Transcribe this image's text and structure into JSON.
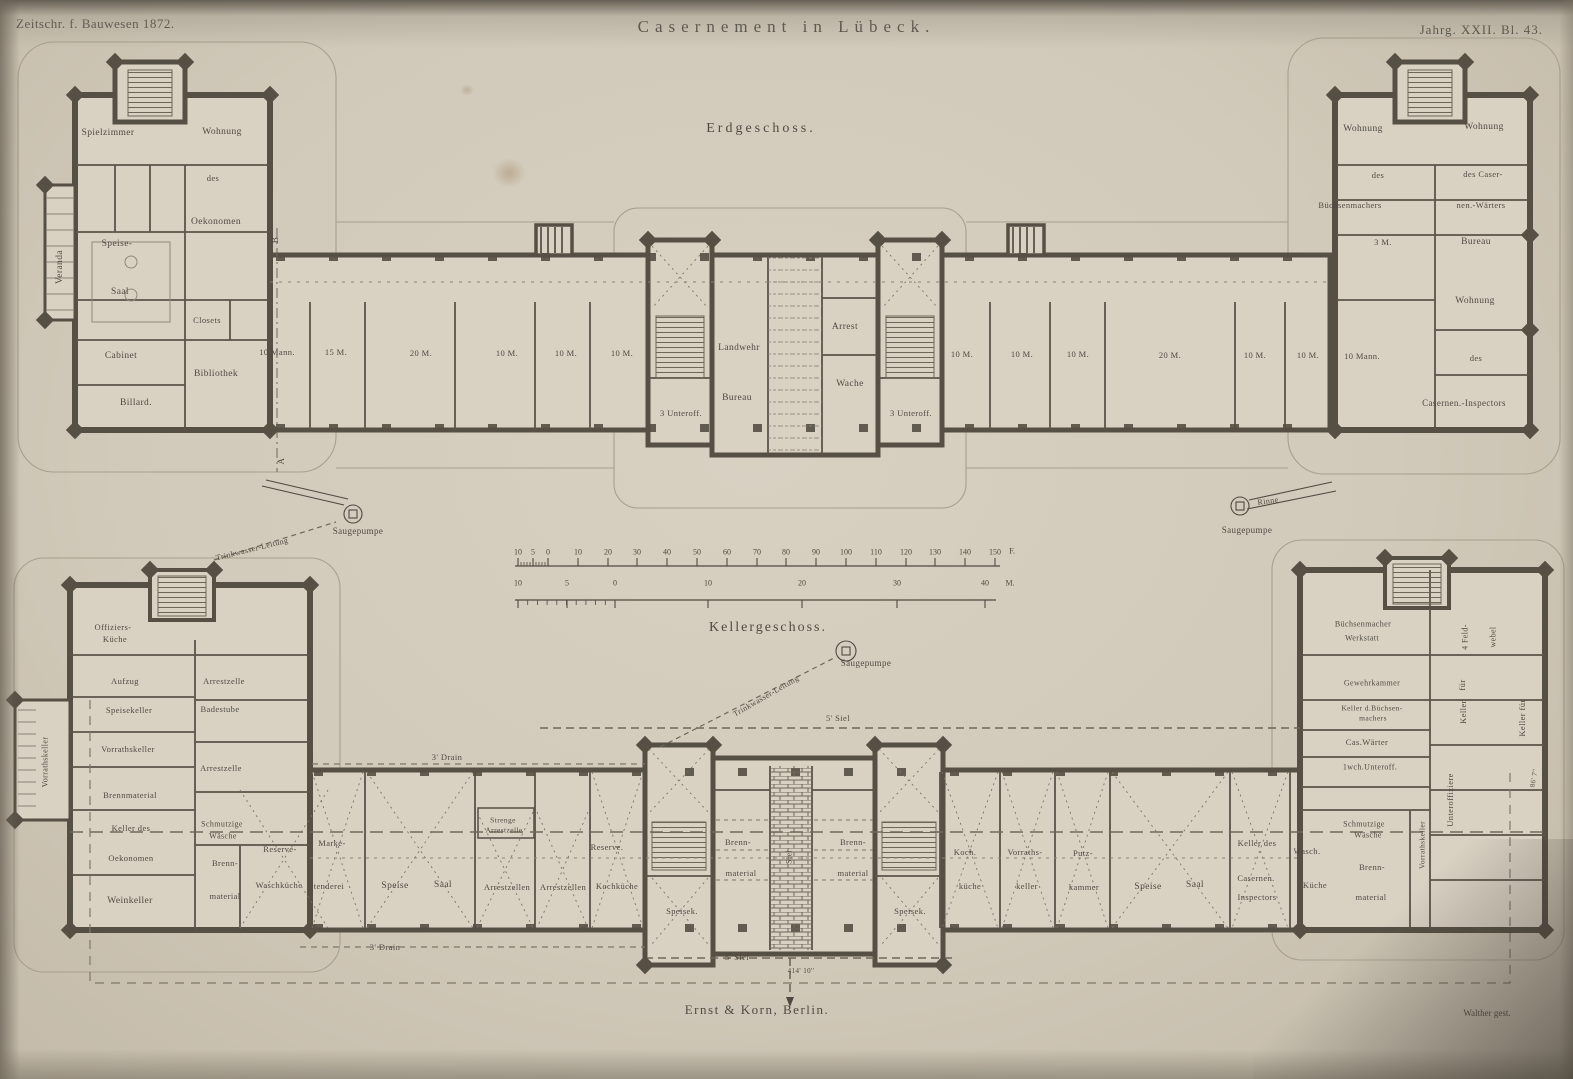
{
  "page": {
    "header": {
      "journal": "Zeitschr. f. Bauwesen 1872.",
      "title": "Casernement in Lübeck.",
      "plate_ref": "Jahrg. XXII. Bl. 43."
    },
    "footer": {
      "publisher": "Ernst & Korn, Berlin.",
      "engraver": "Walther gest."
    }
  },
  "colors": {
    "paper": "#d6cfc0",
    "ink": "#4f4a41",
    "wall": "#564f44",
    "line_light": "#a59d8c",
    "dash": "#6f6859",
    "shadow": "#5b5547"
  },
  "floors": [
    {
      "name": "Erdgeschoss",
      "labels": [
        {
          "t": "Erdgeschoss.",
          "x": 761,
          "y": 129,
          "s": 14,
          "ls": 3
        },
        {
          "t": "Spielzimmer",
          "x": 108,
          "y": 133
        },
        {
          "t": "Wohnung",
          "x": 222,
          "y": 132
        },
        {
          "t": "des",
          "x": 213,
          "y": 178,
          "s": 8.5
        },
        {
          "t": "Oekonomen",
          "x": 216,
          "y": 222
        },
        {
          "t": "Speise-",
          "x": 117,
          "y": 244
        },
        {
          "t": "Saal",
          "x": 120,
          "y": 292
        },
        {
          "t": "Veranda",
          "x": 60,
          "y": 267,
          "r": -90
        },
        {
          "t": "Closets",
          "x": 207,
          "y": 320,
          "s": 8.5
        },
        {
          "t": "Cabinet",
          "x": 121,
          "y": 356
        },
        {
          "t": "Bibliothek",
          "x": 216,
          "y": 374
        },
        {
          "t": "Billard.",
          "x": 136,
          "y": 403
        },
        {
          "t": "10 Mann.",
          "x": 277,
          "y": 352,
          "s": 8.5
        },
        {
          "t": "15 M.",
          "x": 336,
          "y": 352,
          "s": 8.5
        },
        {
          "t": "20 M.",
          "x": 421,
          "y": 353,
          "s": 8.5
        },
        {
          "t": "10 M.",
          "x": 507,
          "y": 353,
          "s": 8.5
        },
        {
          "t": "10 M.",
          "x": 566,
          "y": 353,
          "s": 8.5
        },
        {
          "t": "10 M.",
          "x": 622,
          "y": 353,
          "s": 8.5
        },
        {
          "t": "Landwehr",
          "x": 739,
          "y": 348
        },
        {
          "t": "Bureau",
          "x": 737,
          "y": 398
        },
        {
          "t": "Arrest",
          "x": 845,
          "y": 327
        },
        {
          "t": "Wache",
          "x": 850,
          "y": 384
        },
        {
          "t": "3 Unteroff.",
          "x": 681,
          "y": 413,
          "s": 8.5
        },
        {
          "t": "3 Unteroff.",
          "x": 911,
          "y": 413,
          "s": 8.5
        },
        {
          "t": "10 M.",
          "x": 962,
          "y": 354,
          "s": 8.5
        },
        {
          "t": "10 M.",
          "x": 1022,
          "y": 354,
          "s": 8.5
        },
        {
          "t": "10 M.",
          "x": 1078,
          "y": 354,
          "s": 8.5
        },
        {
          "t": "20 M.",
          "x": 1170,
          "y": 355,
          "s": 8.5
        },
        {
          "t": "10 M.",
          "x": 1255,
          "y": 355,
          "s": 8.5
        },
        {
          "t": "10 M.",
          "x": 1308,
          "y": 355,
          "s": 8.5
        },
        {
          "t": "10 Mann.",
          "x": 1362,
          "y": 356,
          "s": 8.5
        },
        {
          "t": "Wohnung",
          "x": 1363,
          "y": 129
        },
        {
          "t": "Wohnung",
          "x": 1484,
          "y": 127
        },
        {
          "t": "des",
          "x": 1378,
          "y": 175,
          "s": 8.5
        },
        {
          "t": "des Caser-",
          "x": 1483,
          "y": 174,
          "s": 8.5
        },
        {
          "t": "Büchsenmachers",
          "x": 1350,
          "y": 205,
          "s": 8.5
        },
        {
          "t": "nen.-Wärters",
          "x": 1481,
          "y": 205,
          "s": 8.5
        },
        {
          "t": "3 M.",
          "x": 1383,
          "y": 242,
          "s": 8.5
        },
        {
          "t": "Bureau",
          "x": 1476,
          "y": 242
        },
        {
          "t": "Wohnung",
          "x": 1475,
          "y": 301
        },
        {
          "t": "des",
          "x": 1476,
          "y": 358,
          "s": 8.5
        },
        {
          "t": "Casernen.-Inspectors",
          "x": 1464,
          "y": 403,
          "s": 9
        },
        {
          "t": "A",
          "x": 281,
          "y": 461,
          "s": 9,
          "r": -90
        },
        {
          "t": "B",
          "x": 275,
          "y": 240,
          "s": 9,
          "r": -90
        },
        {
          "t": "Saugepumpe",
          "x": 358,
          "y": 531,
          "s": 9
        },
        {
          "t": "Trinkwasser-Leitung",
          "x": 252,
          "y": 549,
          "r": -14,
          "s": 8
        },
        {
          "t": "Rinne",
          "x": 1268,
          "y": 501,
          "r": -8,
          "s": 8
        },
        {
          "t": "Saugepumpe",
          "x": 1247,
          "y": 530,
          "s": 9
        }
      ]
    },
    {
      "name": "Kellergeschoss",
      "labels": [
        {
          "t": "Kellergeschoss.",
          "x": 768,
          "y": 628,
          "s": 14,
          "ls": 2
        },
        {
          "t": "Saugepumpe",
          "x": 866,
          "y": 663,
          "s": 9
        },
        {
          "t": "Trinkwasser-Leitung",
          "x": 766,
          "y": 696,
          "r": -30,
          "s": 8
        },
        {
          "t": "5' Siel",
          "x": 838,
          "y": 718,
          "s": 8.5
        },
        {
          "t": "3' Drain",
          "x": 447,
          "y": 757,
          "s": 8.5
        },
        {
          "t": "Offiziers-",
          "x": 113,
          "y": 627,
          "s": 8.5
        },
        {
          "t": "Küche",
          "x": 115,
          "y": 639,
          "s": 8.5
        },
        {
          "t": "Aufzug",
          "x": 125,
          "y": 681,
          "s": 8.5
        },
        {
          "t": "Arrestzelle",
          "x": 224,
          "y": 681,
          "s": 8.5
        },
        {
          "t": "Speisekeller",
          "x": 129,
          "y": 710,
          "s": 8.5
        },
        {
          "t": "Badestube",
          "x": 220,
          "y": 709,
          "s": 8.5
        },
        {
          "t": "Vorrathskeller",
          "x": 128,
          "y": 749,
          "s": 8.5
        },
        {
          "t": "Arrestzelle",
          "x": 221,
          "y": 768,
          "s": 8.5
        },
        {
          "t": "Brennmaterial",
          "x": 130,
          "y": 795,
          "s": 8.5
        },
        {
          "t": "Keller des",
          "x": 131,
          "y": 828,
          "s": 8.5
        },
        {
          "t": "Oekonomen",
          "x": 131,
          "y": 858,
          "s": 8.5
        },
        {
          "t": "Weinkeller",
          "x": 130,
          "y": 901
        },
        {
          "t": "Schmutzige",
          "x": 222,
          "y": 824,
          "s": 8
        },
        {
          "t": "Wäsche",
          "x": 223,
          "y": 836,
          "s": 8
        },
        {
          "t": "Brenn-",
          "x": 225,
          "y": 863,
          "s": 8.5
        },
        {
          "t": "material",
          "x": 225,
          "y": 896,
          "s": 8.5
        },
        {
          "t": "Reserve-",
          "x": 280,
          "y": 849,
          "s": 8.5
        },
        {
          "t": "Waschküche",
          "x": 279,
          "y": 885,
          "s": 8.5
        },
        {
          "t": "Vorrathskeller",
          "x": 45,
          "y": 762,
          "r": -90,
          "s": 8
        },
        {
          "t": "Marke-",
          "x": 332,
          "y": 843,
          "s": 8.5
        },
        {
          "t": "tenderei",
          "x": 329,
          "y": 886,
          "s": 8.5
        },
        {
          "t": "Speise",
          "x": 395,
          "y": 886
        },
        {
          "t": "Saal",
          "x": 443,
          "y": 885
        },
        {
          "t": "Strenge",
          "x": 503,
          "y": 820,
          "s": 7.5
        },
        {
          "t": "Arrestzelle",
          "x": 504,
          "y": 830,
          "s": 7.5
        },
        {
          "t": "Arrestzellen",
          "x": 507,
          "y": 887,
          "s": 8.5
        },
        {
          "t": "Arrestzellen",
          "x": 563,
          "y": 887,
          "s": 8.5
        },
        {
          "t": "Reserve.",
          "x": 607,
          "y": 847,
          "s": 8.5
        },
        {
          "t": "Kochküche",
          "x": 617,
          "y": 886,
          "s": 8.5
        },
        {
          "t": "Brenn-",
          "x": 738,
          "y": 842,
          "s": 8.5
        },
        {
          "t": "material",
          "x": 741,
          "y": 873,
          "s": 8.5
        },
        {
          "t": "Brenn-",
          "x": 853,
          "y": 842,
          "s": 8.5
        },
        {
          "t": "material",
          "x": 853,
          "y": 873,
          "s": 8.5
        },
        {
          "t": "Speisek.",
          "x": 682,
          "y": 911,
          "s": 8.5
        },
        {
          "t": "Speisek.",
          "x": 910,
          "y": 911,
          "s": 8.5
        },
        {
          "t": "Siel",
          "x": 789,
          "y": 857,
          "r": -90,
          "s": 8
        },
        {
          "t": "Koch.",
          "x": 965,
          "y": 852,
          "s": 8.5
        },
        {
          "t": "küche",
          "x": 970,
          "y": 886,
          "s": 8.5
        },
        {
          "t": "Vorraths-",
          "x": 1025,
          "y": 852,
          "s": 8.5
        },
        {
          "t": "keller",
          "x": 1027,
          "y": 886,
          "s": 8.5
        },
        {
          "t": "Putz-",
          "x": 1083,
          "y": 853,
          "s": 8.5
        },
        {
          "t": "kammer",
          "x": 1084,
          "y": 887,
          "s": 8.5
        },
        {
          "t": "Speise",
          "x": 1148,
          "y": 887
        },
        {
          "t": "Saal",
          "x": 1195,
          "y": 885
        },
        {
          "t": "Keller des",
          "x": 1257,
          "y": 843,
          "s": 8.5
        },
        {
          "t": "Casernen.",
          "x": 1256,
          "y": 878,
          "s": 8.5
        },
        {
          "t": "Inspectors",
          "x": 1257,
          "y": 897,
          "s": 8.5
        },
        {
          "t": "Wasch.",
          "x": 1307,
          "y": 851,
          "s": 8.5
        },
        {
          "t": "Küche",
          "x": 1315,
          "y": 885,
          "s": 8.5
        },
        {
          "t": "Büchsenmacher",
          "x": 1363,
          "y": 624,
          "s": 8
        },
        {
          "t": "Werkstatt",
          "x": 1362,
          "y": 638,
          "s": 8
        },
        {
          "t": "4 Feld-",
          "x": 1465,
          "y": 637,
          "r": -90,
          "s": 8
        },
        {
          "t": "webel",
          "x": 1493,
          "y": 637,
          "r": -90,
          "s": 8
        },
        {
          "t": "Gewehrkammer",
          "x": 1372,
          "y": 683,
          "s": 8
        },
        {
          "t": "Keller d.Büchsen-",
          "x": 1372,
          "y": 708,
          "s": 7.5
        },
        {
          "t": "machers",
          "x": 1373,
          "y": 718,
          "s": 7.5
        },
        {
          "t": "Cas.Wärter",
          "x": 1367,
          "y": 742,
          "s": 8.5
        },
        {
          "t": "1wch.Unteroff.",
          "x": 1370,
          "y": 767,
          "s": 8
        },
        {
          "t": "für",
          "x": 1462,
          "y": 685,
          "r": -90,
          "s": 8.5
        },
        {
          "t": "Keller",
          "x": 1463,
          "y": 712,
          "r": -90,
          "s": 8.5
        },
        {
          "t": "Unteroffiziere",
          "x": 1450,
          "y": 800,
          "r": -90,
          "s": 8.5
        },
        {
          "t": "Keller für",
          "x": 1522,
          "y": 718,
          "r": -90,
          "s": 8.5
        },
        {
          "t": "Vorrathskeller",
          "x": 1422,
          "y": 845,
          "r": -90,
          "s": 7.5
        },
        {
          "t": "Schmutzige",
          "x": 1364,
          "y": 824,
          "s": 8
        },
        {
          "t": "Wäsche",
          "x": 1368,
          "y": 835,
          "s": 8
        },
        {
          "t": "Brenn-",
          "x": 1372,
          "y": 867,
          "s": 8.5
        },
        {
          "t": "material",
          "x": 1371,
          "y": 897,
          "s": 8.5
        },
        {
          "t": "86' 7''",
          "x": 1534,
          "y": 778,
          "r": -80,
          "s": 7
        },
        {
          "t": "3' Drain",
          "x": 385,
          "y": 947,
          "s": 8.5
        },
        {
          "t": "5' Siel",
          "x": 737,
          "y": 957,
          "s": 8.5
        },
        {
          "t": "414' 10''",
          "x": 801,
          "y": 971,
          "s": 7
        }
      ]
    }
  ],
  "scale_bars": {
    "feet": {
      "unit": "F.",
      "ticks": [
        {
          "t": "10",
          "x": 518,
          "y": 552
        },
        {
          "t": "5",
          "x": 533,
          "y": 552
        },
        {
          "t": "0",
          "x": 548,
          "y": 552
        },
        {
          "t": "10",
          "x": 578,
          "y": 552
        },
        {
          "t": "20",
          "x": 608,
          "y": 552
        },
        {
          "t": "30",
          "x": 637,
          "y": 552
        },
        {
          "t": "40",
          "x": 667,
          "y": 552
        },
        {
          "t": "50",
          "x": 697,
          "y": 552
        },
        {
          "t": "60",
          "x": 727,
          "y": 552
        },
        {
          "t": "70",
          "x": 757,
          "y": 552
        },
        {
          "t": "80",
          "x": 786,
          "y": 552
        },
        {
          "t": "90",
          "x": 816,
          "y": 552
        },
        {
          "t": "100",
          "x": 846,
          "y": 552
        },
        {
          "t": "110",
          "x": 876,
          "y": 552
        },
        {
          "t": "120",
          "x": 906,
          "y": 552
        },
        {
          "t": "130",
          "x": 935,
          "y": 552
        },
        {
          "t": "140",
          "x": 965,
          "y": 552
        },
        {
          "t": "150",
          "x": 995,
          "y": 552
        },
        {
          "t": "F.",
          "x": 1012,
          "y": 551
        }
      ]
    },
    "meters": {
      "unit": "M.",
      "ticks": [
        {
          "t": "10",
          "x": 518,
          "y": 583
        },
        {
          "t": "5",
          "x": 567,
          "y": 583
        },
        {
          "t": "0",
          "x": 615,
          "y": 583
        },
        {
          "t": "10",
          "x": 708,
          "y": 583
        },
        {
          "t": "20",
          "x": 802,
          "y": 583
        },
        {
          "t": "30",
          "x": 897,
          "y": 583
        },
        {
          "t": "40",
          "x": 985,
          "y": 583
        },
        {
          "t": "M.",
          "x": 1010,
          "y": 583
        }
      ]
    }
  }
}
